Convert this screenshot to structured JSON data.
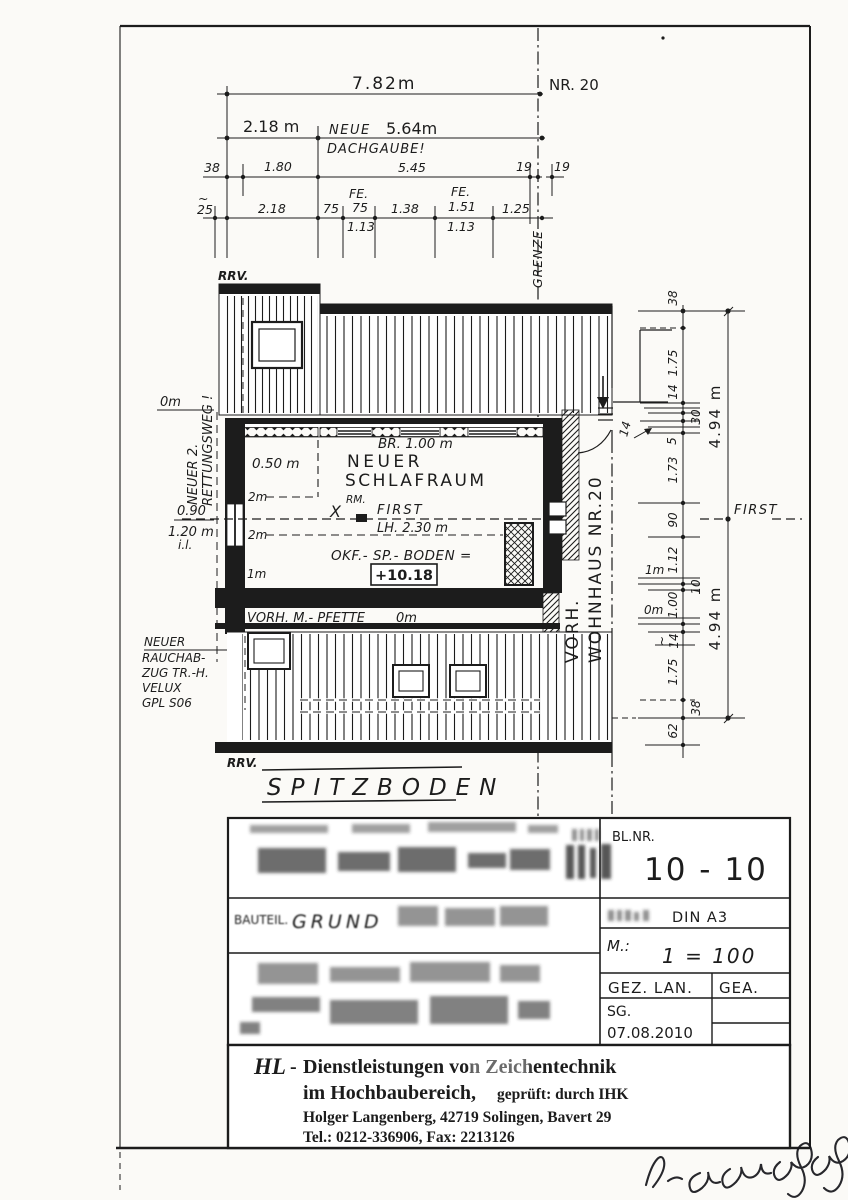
{
  "top_dims": {
    "overall": "7.82m",
    "nr20": "NR. 20",
    "d218m": "2.18 m",
    "neue": "NEUE",
    "d564": "5.64m",
    "dachgaube": "DACHGAUBE!",
    "d38": "38",
    "d180": "1.80",
    "d545": "5.45",
    "d19a": "19",
    "d19b": "19",
    "tilde": "~",
    "d25": "25",
    "d218": "2.18",
    "d75a": "75",
    "fe1": "FE.",
    "d75b": "75",
    "d138": "1.38",
    "fe2": "FE.",
    "d151": "1.51",
    "d125": "1.25",
    "d113a": "1.13",
    "d113b": "1.13",
    "grenze": "GRENZE"
  },
  "plan": {
    "rrv_top": "RRV.",
    "rrv_bottom": "RRV.",
    "rescue1": "NEUER 2.",
    "rescue2": "RETTUNGSWEG !",
    "lvl0m_left": "0m",
    "d050": "0.50 m",
    "br100": "BR. 1.00 m",
    "room1": "NEUER",
    "room2": "SCHLAFRAUM",
    "lvl2m_a": "2m",
    "lvl2m_b": "2m",
    "lvl1m": "1m",
    "x": "X",
    "rm": "RM.",
    "first": "FIRST",
    "lh": "LH. 2.30 m",
    "d090": "0.90",
    "d120": "1.20 m",
    "il": "i.l.",
    "okf": "OKF.- SP.- BODEN =",
    "level": "+10.18",
    "pfette": "VORH. M.- PFETTE",
    "pfette0": "0m",
    "rauch1": "NEUER",
    "rauch2": "RAUCHAB-",
    "rauch3": "ZUG TR.-H.",
    "rauch4": "VELUX",
    "rauch5": "GPL S06",
    "vorh": "VORH.",
    "wohnhaus": "WOHNHAUS  NR.20",
    "title": "SPITZBODEN"
  },
  "right_dims": {
    "r38t": "38",
    "r175a": "1.75",
    "r14a": "14",
    "r30": "30",
    "r5": "5",
    "r173": "1.73",
    "r90": "90",
    "r112": "1.12",
    "r10": "10",
    "r100": "1.00",
    "rtilde": "~",
    "r14b": "14",
    "r175b": "1.75",
    "r38b": "38",
    "r62": "62",
    "overall_top": "4.94 m",
    "overall_bottom": "4.94 m",
    "lvl1m": "1m",
    "lvl0m": "0m",
    "first": "FIRST",
    "arrow14": "14"
  },
  "titleblock": {
    "blnr": "BL.NR.",
    "sheet": "10 - 10",
    "din": "DIN A3",
    "m": "M.:",
    "scale": "1 = 100",
    "gez": "GEZ. LAN.",
    "gea": "GEA.",
    "sg": "SG.",
    "date": "07.08.2010",
    "bauteil": "BAUTEIL.",
    "grund": "GRUND"
  },
  "company": {
    "hl": "HL",
    "dash": "-",
    "line1": "Dienstleistungen von Zeichentechnik",
    "line2": "im Hochbaubereich,",
    "line2b": "geprüft: durch IHK",
    "line3": "Holger Langenberg, 42719 Solingen, Bavert 29",
    "line4": "Tel.: 0212-336906, Fax: 2213126"
  }
}
